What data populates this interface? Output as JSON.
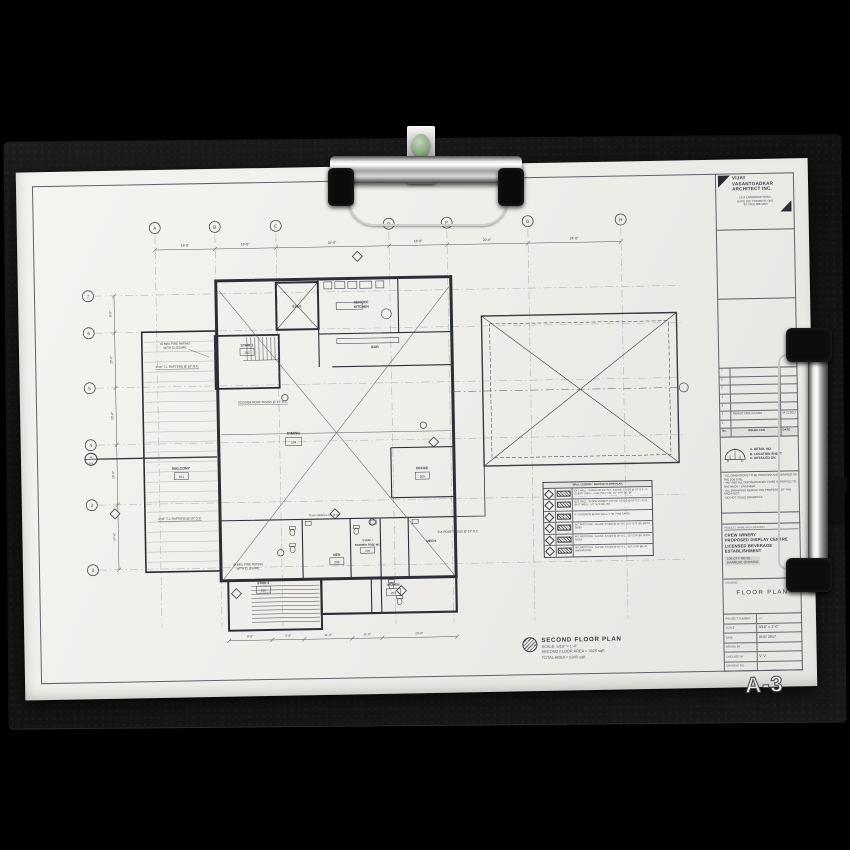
{
  "colors": {
    "paper": "#efeeeb",
    "board": "#141414",
    "ink": "#3a3a42",
    "clip_metal": "#d6d6d6",
    "clip_button_green": "#8cab84"
  },
  "title_block": {
    "architect": {
      "name1": "VIJAY",
      "name2": "VASANTGADKAR",
      "name3": "ARCHITECT  INC.",
      "addr1": "1414 LAWRENCE ROAD,",
      "addr2": "SUITE 200, TORONTO, ONT.",
      "addr3": "Tel: (416) 288-1900"
    },
    "revisions": {
      "header": {
        "no": "No.",
        "issued": "ISSUED FOR",
        "date": "DATE"
      },
      "rows": [
        {
          "no": "7",
          "issued": "",
          "date": ""
        },
        {
          "no": "6",
          "issued": "",
          "date": ""
        },
        {
          "no": "5",
          "issued": "",
          "date": ""
        },
        {
          "no": "4",
          "issued": "",
          "date": ""
        },
        {
          "no": "3",
          "issued": "",
          "date": ""
        },
        {
          "no": "2",
          "issued": "PERMIT APPLICATION",
          "date": "04.21.2017"
        },
        {
          "no": "1",
          "issued": "",
          "date": ""
        }
      ]
    },
    "detail_key": {
      "sym_a": "A",
      "sym_b": "B",
      "sym_c": "C",
      "label_a": "A. DETAIL NO.",
      "label_b": "B. LOCATION SHEET",
      "label_c": "C. DETAILED ON"
    },
    "notes": [
      "- ALL DIMENSIONS TO BE CHECKED AND VERIFIED ON THE JOB SITE.",
      "- ANY AND ALL DISCREPANCIES TO BE REPORTED TO THE ARCH. / ENGINEER.",
      "- ALL DRAWINGS REMAIN THE PROPERTY OF THE ARCHITECT.",
      "- DO NOT SCALE DRAWINGS."
    ],
    "project": {
      "label": "PROJECT NAME AND LOCATION",
      "name1": "CREW  WINERY",
      "name2": "PROPOSED  DISPLAY  CENTRE",
      "name3": "LICENSED  BEVERAGE",
      "name4": "ESTABLISHMENT",
      "loc1": "108 CTY RD 50,",
      "loc2": "HARROW, ONTARIO"
    },
    "drawing": {
      "label": "DRAWING",
      "title": "FLOOR  PLAN"
    },
    "info": {
      "rows": [
        {
          "label": "PROJECT NUMBER",
          "value": "—"
        },
        {
          "label": "SCALE",
          "value": "3/16\" = 1'-0\""
        },
        {
          "label": "DATE",
          "value": "AUG 2017"
        },
        {
          "label": "DRAWN BY",
          "value": ""
        },
        {
          "label": "CHECKED BY",
          "value": "V. V."
        },
        {
          "label": "DRAWING NO.",
          "value": ""
        }
      ],
      "sheet_no": "A-3"
    }
  },
  "plan_title": {
    "title": "SECOND FLOOR  PLAN",
    "scale": "SCALE: 3/16\" = 1'-0\"",
    "area1": "SECOND FLOOR AREA = 3920 sqft",
    "area2": "TOTAL AREA = 8240 sqft"
  },
  "plan": {
    "grid_cols": [
      "A",
      "B",
      "C",
      "D",
      "E",
      "G",
      "H"
    ],
    "grid_rows": [
      "7",
      "6",
      "5",
      "4",
      "3",
      "2"
    ],
    "dims_top": [
      "16'-0\"",
      "16'-0\"",
      "24'-0\"",
      "16'-0\"",
      "20'-6\"",
      "24'-0\""
    ],
    "dims_left": [
      "8'-0\"",
      "15'-0\"",
      "15'-6\"",
      "16'-0\"",
      "17'-6\""
    ],
    "dims_bottom": [
      "8'-0\"",
      "5'-0\"",
      "11'-0\"",
      "11'-0\"",
      "20'-0\""
    ],
    "rooms": [
      {
        "name": "ELEV.",
        "tag": ""
      },
      {
        "name": "STAIR 1",
        "tag": "202"
      },
      {
        "name": "SERVICE",
        "name2": "KITCHEN",
        "tag": ""
      },
      {
        "name": "BAR",
        "tag": ""
      },
      {
        "name": "DINING",
        "tag": "204"
      },
      {
        "name": "OFFICE",
        "tag": "205"
      },
      {
        "name": "BALCONY",
        "tag": "201"
      },
      {
        "name": "MEN",
        "tag": "208"
      },
      {
        "name": "STAFF /",
        "name2": "BARRIER FREE WC",
        "tag": "209"
      },
      {
        "name": "WOMEN",
        "tag": "207"
      },
      {
        "name": "MECH.",
        "tag": ""
      },
      {
        "name": "STAIR 2",
        "tag": "210"
      }
    ],
    "notes": {
      "fire_a": "45 MIN. FIRE RATING",
      "fire_b": "WITH CLOSURE",
      "rafters": "2\"x6\" T.J. RAFTERS @ 16\" O.C.",
      "scissor": "SCISSOR ROOF TRUSS @ 24\" O.C.",
      "rooftruss": "2x6 ROOF TRUSS @ 24\" O.C.",
      "travel": "Travel distance 60' (9 m)"
    },
    "section_marker": {
      "letter": "A",
      "sheet": "A-5"
    },
    "legend": {
      "header": "WALL LEGEND :   SECOND FLOOR PLAN",
      "rows": [
        "EXT. WALL : SIDING ON 3/4\" PLY., 2x6 WD. STUDS @ 16\" O.C., R-22 BATT INSUL., 6 MIL POLY V.B., 1/2\" GYP. BD. INT.",
        "EXT. WALL : STONE VENEER, 2x6 WD. STUDS @ 16\" O.C., R-22 BATT INSUL., 1/2\" GYP. BD. INT.",
        "8\" CONCRETE BLOCK WALL, 2 HR. FIRE RATED",
        "INT. PARTITION : 2x6 WD. STUDS @ 16\" O.C., 1/2\" GYP. BD. BOTH SIDES",
        "INT. PARTITION : 2x4 WD. STUDS @ 16\" O.C., 1/2\" GYP. BD. BOTH SIDES",
        "INT. PARTITION : 2x4 WD. STUDS @ 16\" O.C., W.R. GYP. BD. AT WASHROOMS"
      ]
    }
  }
}
